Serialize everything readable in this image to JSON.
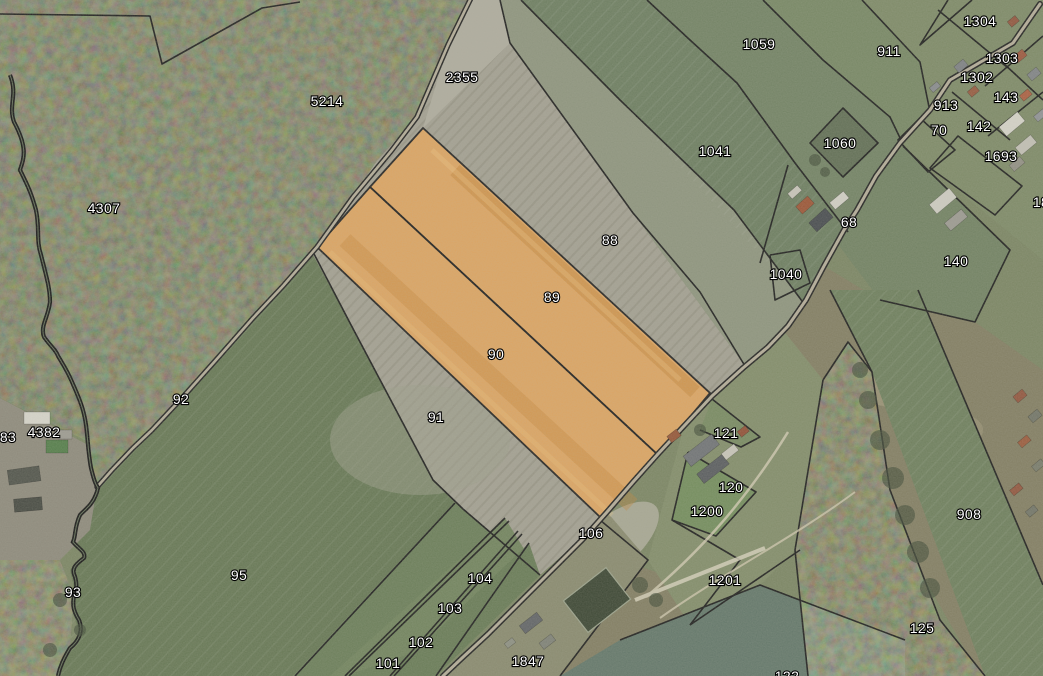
{
  "app": {
    "type": "cadastral-parcel-map-viewer",
    "view": "aerial-imagery-with-parcels"
  },
  "map": {
    "selected_parcels": [
      "89",
      "90"
    ],
    "highlight_color": "#e2a45c",
    "boundary_color": "#161616",
    "label_text_color": "#ffffff",
    "label_outline_color": "#000000",
    "parcel_labels": [
      {
        "id": "1304",
        "x": 980,
        "y": 26
      },
      {
        "id": "1059",
        "x": 759,
        "y": 49
      },
      {
        "id": "911",
        "x": 889,
        "y": 56
      },
      {
        "id": "1303",
        "x": 1002,
        "y": 63
      },
      {
        "id": "2355",
        "x": 462,
        "y": 82
      },
      {
        "id": "1302",
        "x": 977,
        "y": 82
      },
      {
        "id": "143",
        "x": 1006,
        "y": 102
      },
      {
        "id": "913",
        "x": 946,
        "y": 110
      },
      {
        "id": "5214",
        "x": 327,
        "y": 106
      },
      {
        "id": "142",
        "x": 979,
        "y": 131
      },
      {
        "id": "70",
        "x": 939,
        "y": 135
      },
      {
        "id": "1060",
        "x": 840,
        "y": 148
      },
      {
        "id": "1041",
        "x": 715,
        "y": 156
      },
      {
        "id": "1693",
        "x": 1001,
        "y": 161
      },
      {
        "id": "18",
        "x": 1041,
        "y": 207
      },
      {
        "id": "4307",
        "x": 104,
        "y": 213
      },
      {
        "id": "68",
        "x": 849,
        "y": 227
      },
      {
        "id": "88",
        "x": 610,
        "y": 245
      },
      {
        "id": "140",
        "x": 956,
        "y": 266
      },
      {
        "id": "1040",
        "x": 786,
        "y": 279
      },
      {
        "id": "89",
        "x": 552,
        "y": 302
      },
      {
        "id": "90",
        "x": 496,
        "y": 359
      },
      {
        "id": "92",
        "x": 181,
        "y": 404
      },
      {
        "id": "91",
        "x": 436,
        "y": 422
      },
      {
        "id": "121",
        "x": 726,
        "y": 438
      },
      {
        "id": "4382",
        "x": 44,
        "y": 437
      },
      {
        "id": "83",
        "x": 8,
        "y": 442
      },
      {
        "id": "120",
        "x": 731,
        "y": 492
      },
      {
        "id": "1200",
        "x": 707,
        "y": 516
      },
      {
        "id": "908",
        "x": 969,
        "y": 519
      },
      {
        "id": "106",
        "x": 591,
        "y": 538
      },
      {
        "id": "95",
        "x": 239,
        "y": 580
      },
      {
        "id": "104",
        "x": 480,
        "y": 583
      },
      {
        "id": "1201",
        "x": 725,
        "y": 585
      },
      {
        "id": "93",
        "x": 73,
        "y": 597
      },
      {
        "id": "103",
        "x": 450,
        "y": 613
      },
      {
        "id": "125",
        "x": 922,
        "y": 633
      },
      {
        "id": "102",
        "x": 421,
        "y": 647
      },
      {
        "id": "1847",
        "x": 528,
        "y": 666
      },
      {
        "id": "101",
        "x": 388,
        "y": 668
      },
      {
        "id": "122",
        "x": 787,
        "y": 681
      }
    ]
  }
}
